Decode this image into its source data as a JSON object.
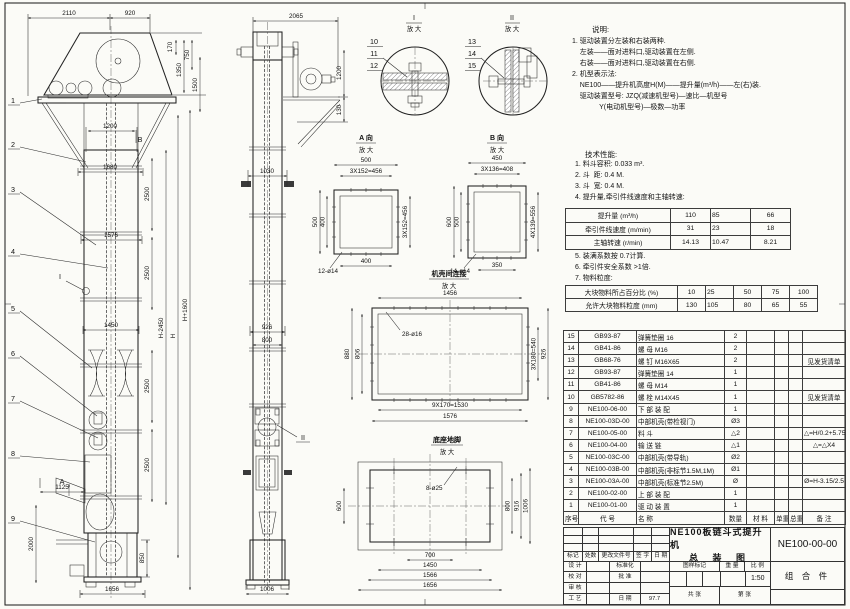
{
  "sheet": {
    "background": "#fbfbf7",
    "ink": "#2a2a2a"
  },
  "front_view": {
    "dim_2110": "2110",
    "dim_920": "920",
    "dim_170": "170",
    "dim_750": "750",
    "dim_1350": "1350",
    "dim_1500": "1500",
    "dim_1200": "1200",
    "dim_1680": "1680",
    "dim_1576": "1576",
    "dim_1450": "1450",
    "dim_2500": "2500",
    "dim_h_minus": "H-2450",
    "dim_h": "H",
    "dim_h_plus": "H+1600",
    "dim_1125": "1125",
    "dim_2000": "2000",
    "dim_850": "850",
    "dim_1656": "1656",
    "balloons": [
      "1",
      "2",
      "3",
      "4",
      "5",
      "6",
      "7",
      "8",
      "9"
    ],
    "mark_a": "A",
    "mark_b": "B",
    "mark_i": "I"
  },
  "side_view": {
    "dim_2065": "2065",
    "dim_1200": "1200",
    "dim_130": "130",
    "dim_1030": "1030",
    "dim_926": "926",
    "dim_800": "800",
    "dim_1006": "1006",
    "mark_ii": "II"
  },
  "detail_I": {
    "label": "I",
    "sub": "放 大",
    "balloons": [
      "10",
      "11",
      "12"
    ]
  },
  "detail_II": {
    "label": "II",
    "sub": "放 大",
    "balloons": [
      "13",
      "14",
      "15"
    ]
  },
  "view_A": {
    "label": "A 向",
    "sub": "放 大",
    "dim_top": "500",
    "dim_top2": "3X152=456",
    "dim_left": "500",
    "dim_left2": "400",
    "dim_right": "3X152=456",
    "dim_bottom": "400",
    "note_holes": "12-ø14"
  },
  "view_B": {
    "label": "B 向",
    "sub": "放 大",
    "dim_top": "450",
    "dim_top2": "3X136=408",
    "dim_left": "600",
    "dim_left2": "500",
    "dim_right": "4X139=556",
    "dim_bottom": "350",
    "note_holes": "14-ø14"
  },
  "casing_joint": {
    "label": "机壳间连接",
    "sub": "放 大",
    "dim_top": "1456",
    "note_holes": "28-ø16",
    "dim_left": "880",
    "dim_left2": "806",
    "dim_right": "3X180=540",
    "dim_right2": "926",
    "dim_bottom": "9X170=1530",
    "dim_bottom2": "1576"
  },
  "base_plan": {
    "label": "底座地脚",
    "sub": "放 大",
    "note_holes": "8-ø25",
    "dim_left": "600",
    "dim_right": "800",
    "dim_right2": "916",
    "dim_right3": "1006",
    "dim_bottom": "700",
    "dim_bottom2": "1450",
    "dim_bottom3": "1566",
    "dim_bottom4": "1656"
  },
  "notes": {
    "title": "说明:",
    "lines": [
      "1. 驱动装置分左装和右装两种.",
      "    左装——面对进料口,驱动装置在左侧.",
      "    右装——面对进料口,驱动装置在右侧.",
      "2. 机型表示法:",
      "    NE100——提升机高度H(M)——提升量(m³/h)——左(右)装.",
      "    驱动装置型号: JZQ(减速机型号)—速比—机型号",
      "              Y(电动机型号)—极数—功率"
    ]
  },
  "tech": {
    "title": "技术性能:",
    "items": [
      "1. 料斗容积: 0.033 m³.",
      "2. 斗  距: 0.4 M.",
      "3. 斗  宽: 0.4 M.",
      "4. 提升量,牵引件线速度和主轴转速:"
    ],
    "items2": [
      "5. 装满系数按 0.7计算.",
      "6. 牵引件安全系数 >1倍.",
      "7. 物料粒度:"
    ]
  },
  "perf_table": {
    "rows": [
      [
        "提升量 (m³/h)",
        "110",
        "85",
        "66"
      ],
      [
        "牵引件线速度 (m/min)",
        "31",
        "23",
        "18"
      ],
      [
        "主轴转速 (r/min)",
        "14.13",
        "10.47",
        "8.21"
      ]
    ]
  },
  "material_table": {
    "rows": [
      [
        "大块物料所占百分比 (%)",
        "10",
        "25",
        "50",
        "75",
        "100"
      ],
      [
        "允许大块物料粒度 (mm)",
        "130",
        "105",
        "80",
        "65",
        "55"
      ]
    ]
  },
  "bom": {
    "rows": [
      [
        "15",
        "GB93-87",
        "弹簧垫圈 16",
        "2",
        "",
        "",
        "",
        ""
      ],
      [
        "14",
        "GB41-86",
        "螺 母 M16",
        "2",
        "",
        "",
        "",
        ""
      ],
      [
        "13",
        "GB68-76",
        "螺 钉 M16X65",
        "2",
        "",
        "",
        "",
        "见发货清单"
      ],
      [
        "12",
        "GB93-87",
        "弹簧垫圈 14",
        "1",
        "",
        "",
        "",
        ""
      ],
      [
        "11",
        "GB41-86",
        "螺 母 M14",
        "1",
        "",
        "",
        "",
        ""
      ],
      [
        "10",
        "GB5782-86",
        "螺 栓 M14X45",
        "1",
        "",
        "",
        "",
        "见发货清单"
      ],
      [
        "9",
        "NE100-06-00",
        "下 部 装 配",
        "1",
        "",
        "",
        "",
        ""
      ],
      [
        "8",
        "NE100-03D-00",
        "中部机壳(带检视门)",
        "Ø3",
        "",
        "",
        "",
        ""
      ],
      [
        "7",
        "NE100-05-00",
        "料 斗",
        "△2",
        "",
        "",
        "",
        "△=H/0.2+5.75"
      ],
      [
        "6",
        "NE100-04-00",
        "输 送 链",
        "△1",
        "",
        "",
        "",
        "△=△X4"
      ],
      [
        "5",
        "NE100-03C-00",
        "中部机壳(带导轨)",
        "Ø2",
        "",
        "",
        "",
        ""
      ],
      [
        "4",
        "NE100-03B-00",
        "中部机壳(非标节1.5M,1M)",
        "Ø1",
        "",
        "",
        "",
        ""
      ],
      [
        "3",
        "NE100-03A-00",
        "中部机壳(标准节2.5M)",
        "Ø",
        "",
        "",
        "",
        "Ø=H-3.15/2.5"
      ],
      [
        "2",
        "NE100-02-00",
        "上 部 装 配",
        "1",
        "",
        "",
        "",
        ""
      ],
      [
        "1",
        "NE100-01-00",
        "驱 动 装 置",
        "1",
        "",
        "",
        "",
        ""
      ]
    ],
    "header": [
      [
        "序号",
        "代 号",
        "名 称",
        "数量",
        "材 料",
        "单重",
        "总重",
        "备 注"
      ]
    ]
  },
  "title_block": {
    "product": "NE100板链斗式提升机",
    "drawing_type": "总 装 图",
    "drawing_no": "NE100-00-00",
    "part_class": "组 合 件",
    "rev_header": [
      "标记",
      "处数",
      "更改文件号",
      "签 字",
      "日 期"
    ],
    "roles": [
      [
        "设 计",
        "",
        "标准化",
        ""
      ],
      [
        "校 对",
        "",
        "批 准",
        ""
      ],
      [
        "审 核",
        "",
        "",
        ""
      ],
      [
        "工 艺",
        "",
        "日 期",
        "97.7"
      ]
    ],
    "mark_label": "图样标记",
    "weight_label": "重 量",
    "scale_label": "比 例",
    "scale": "1:50",
    "sheet_total": "共  张",
    "sheet_no": "第  张"
  }
}
